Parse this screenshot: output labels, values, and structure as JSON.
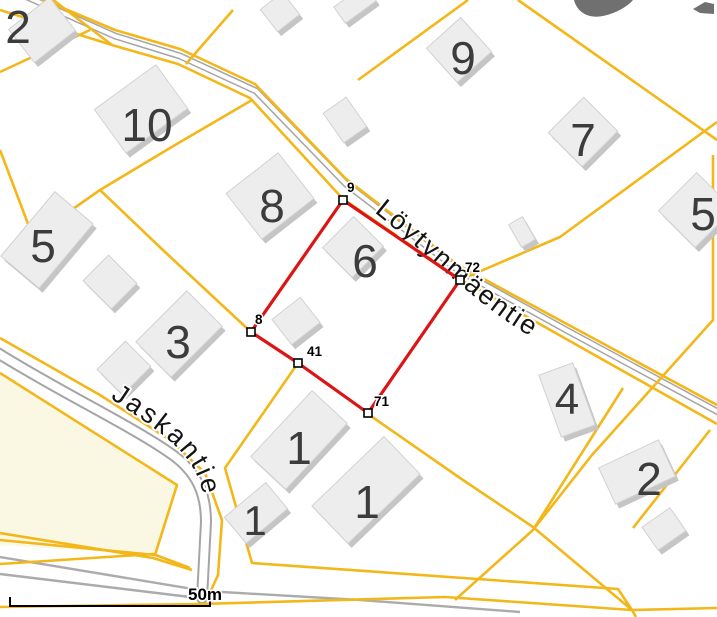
{
  "map": {
    "width": 717,
    "height": 617,
    "colors": {
      "background": "#ffffff",
      "cadastral": "#f3b71a",
      "road_casing": "#a5a5a5",
      "road_fill": "#ffffff",
      "minor_road": "#ababab",
      "building_roof": "#ededed",
      "building_side": "#c5c5c5",
      "building_stroke": "#d2d2d2",
      "measurement": "#dc1414",
      "field": "#faf7e2",
      "parcel_label": "#3c3c3c",
      "street_label": "#141414",
      "glyph": "#707070"
    },
    "field_path": "M 0,373 L 177,485 L 155,555 L 0,545 Z",
    "roads": {
      "main": {
        "name": "Löytynmäentie",
        "path": "M 25,-4 L 115,36 L 180,56 L 256,91 L 346,184 L 458,270 L 568,331 L 720,413",
        "casing": 7,
        "inner": 4
      },
      "jaskantie": {
        "name": "Jaskantie",
        "path": "M -4,352 C 60,392 130,425 170,453 C 198,472 206,495 206,522 L 202,598",
        "casing": 12,
        "inner": 8
      },
      "minor": [
        "M 0,557 L 205,591 L 360,600 L 520,612",
        "M 0,574 L 190,597"
      ]
    },
    "cadastral_lines": [
      "M 0,10 L 112,45 L 178,64 L 250,98 L 343,199 L 460,279 L 568,340 L 717,424",
      "M 25,-8 L 115,30 L 180,49 L 255,84 L 345,178 L 458,265 L 565,323 L 717,405",
      "M 48,-4 L 112,45",
      "M 233,10 L 186,64",
      "M 90,30 L 0,72",
      "M 0,150 L 33,237",
      "M 33,237 L 100,190 L 170,148 L 252,100",
      "M 100,190 L 165,252 L 251,332 L 298,363 L 225,468 L 252,563 L 618,589 L 632,610",
      "M 368,414 L 460,478 L 533,527 L 632,610",
      "M 623,388 L 533,530 L 455,600",
      "M 0,533 L 153,558 L 192,570",
      "M 0,564 L 153,554 L 190,568",
      "M 0,607 L 200,604 L 445,597 L 632,610 L 717,608",
      "M 632,610 L 636,617",
      "M 0,338 L 100,395 L 170,440 L 205,473 L 222,520 L 218,575 L 208,597",
      "M 0,373 L 177,485 L 155,555 L 0,540",
      "M 468,0 L 358,80",
      "M 518,0 L 717,140",
      "M 717,122 L 560,237 L 462,279",
      "M 713,155 L 713,320 L 592,455 L 533,530",
      "M 710,430 L 633,528"
    ],
    "street_labels": [
      {
        "text": "Löytynmäentie",
        "path": "M 374,212 C 430,256 472,300 520,330 C 556,352 580,364 608,380",
        "size": 27,
        "spacing": 2
      },
      {
        "text": "Jaskantie",
        "path": "M 110,398 C 155,428 186,448 198,478 C 208,502 207,532 203,578",
        "size": 27,
        "spacing": 3
      }
    ],
    "buildings": [
      {
        "x": 42,
        "y": 30,
        "w": 52,
        "h": 42,
        "r": -38
      },
      {
        "x": 141,
        "y": 109,
        "w": 76,
        "h": 54,
        "r": -36
      },
      {
        "x": 270,
        "y": 196,
        "w": 66,
        "h": 58,
        "r": -38
      },
      {
        "x": 459,
        "y": 50,
        "w": 46,
        "h": 46,
        "r": -42
      },
      {
        "x": 280,
        "y": 12,
        "w": 28,
        "h": 28,
        "r": -38
      },
      {
        "x": 355,
        "y": 4,
        "w": 38,
        "h": 20,
        "r": -36
      },
      {
        "x": 345,
        "y": 120,
        "w": 28,
        "h": 36,
        "r": -35
      },
      {
        "x": 583,
        "y": 132,
        "w": 50,
        "h": 48,
        "r": -45
      },
      {
        "x": 696,
        "y": 210,
        "w": 54,
        "h": 52,
        "r": -45
      },
      {
        "x": 522,
        "y": 232,
        "w": 16,
        "h": 26,
        "r": -30
      },
      {
        "x": 47,
        "y": 240,
        "w": 84,
        "h": 50,
        "r": -50
      },
      {
        "x": 110,
        "y": 282,
        "w": 36,
        "h": 40,
        "r": -45
      },
      {
        "x": 179,
        "y": 334,
        "w": 72,
        "h": 50,
        "r": -45
      },
      {
        "x": 124,
        "y": 368,
        "w": 40,
        "h": 36,
        "r": -45
      },
      {
        "x": 353,
        "y": 247,
        "w": 44,
        "h": 42,
        "r": -45
      },
      {
        "x": 296,
        "y": 321,
        "w": 36,
        "h": 32,
        "r": -38
      },
      {
        "x": 567,
        "y": 400,
        "w": 36,
        "h": 66,
        "r": -20
      },
      {
        "x": 299,
        "y": 440,
        "w": 90,
        "h": 48,
        "r": -47
      },
      {
        "x": 366,
        "y": 490,
        "w": 100,
        "h": 52,
        "r": -44
      },
      {
        "x": 256,
        "y": 513,
        "w": 54,
        "h": 34,
        "r": -40
      },
      {
        "x": 637,
        "y": 472,
        "w": 66,
        "h": 40,
        "r": -25
      },
      {
        "x": 664,
        "y": 529,
        "w": 34,
        "h": 28,
        "r": -35
      }
    ],
    "parcel_labels": [
      {
        "text": "2",
        "x": 18,
        "y": 43,
        "size": 46
      },
      {
        "text": "10",
        "x": 147,
        "y": 141,
        "size": 46
      },
      {
        "text": "8",
        "x": 272,
        "y": 222,
        "size": 46
      },
      {
        "text": "9",
        "x": 463,
        "y": 74,
        "size": 46
      },
      {
        "text": "7",
        "x": 583,
        "y": 156,
        "size": 46
      },
      {
        "text": "5",
        "x": 703,
        "y": 230,
        "size": 46
      },
      {
        "text": "5",
        "x": 43,
        "y": 262,
        "size": 46
      },
      {
        "text": "3",
        "x": 178,
        "y": 358,
        "size": 46
      },
      {
        "text": "6",
        "x": 365,
        "y": 277,
        "size": 46
      },
      {
        "text": "4",
        "x": 567,
        "y": 414,
        "size": 44
      },
      {
        "text": "2",
        "x": 649,
        "y": 495,
        "size": 46
      },
      {
        "text": "1",
        "x": 299,
        "y": 464,
        "size": 46
      },
      {
        "text": "1",
        "x": 367,
        "y": 518,
        "size": 46
      },
      {
        "text": "1",
        "x": 255,
        "y": 535,
        "size": 42
      }
    ],
    "measurement": {
      "color": "#dc1414",
      "stroke_width": 3.2,
      "closed": true,
      "points": [
        {
          "label": "9",
          "x": 343,
          "y": 200,
          "lx": 347,
          "ly": 192
        },
        {
          "label": "72",
          "x": 460,
          "y": 280,
          "lx": 465,
          "ly": 272
        },
        {
          "label": "71",
          "x": 368,
          "y": 413,
          "lx": 374,
          "ly": 406
        },
        {
          "label": "41",
          "x": 298,
          "y": 363,
          "lx": 307,
          "ly": 356
        },
        {
          "label": "8",
          "x": 251,
          "y": 332,
          "lx": 255,
          "ly": 324
        }
      ]
    },
    "vertex_marker": {
      "size": 8,
      "fill": "#ffffff",
      "stroke": "#000000"
    },
    "scale_bar": {
      "label": "50m",
      "x1": 10,
      "x2": 210,
      "y": 606,
      "tick_h": 9,
      "label_x": 205,
      "label_y": 600
    },
    "partial_glyphs": [
      "M 574,0 C 577,12 588,19 603,16 C 617,13 628,6 633,0 Z",
      "M 693,9 L 705,2 L 714,4 L 714,14 L 700,13 Z"
    ]
  }
}
